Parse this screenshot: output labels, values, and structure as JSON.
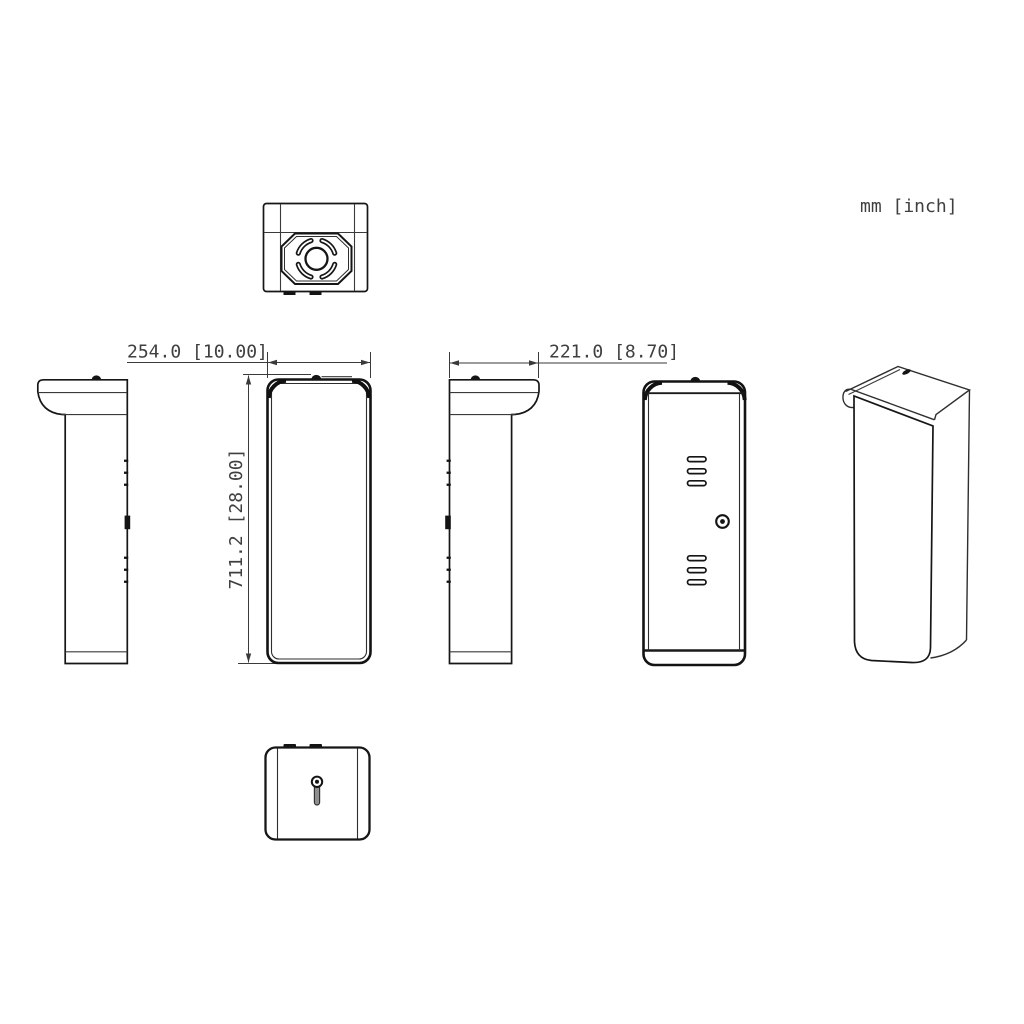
{
  "drawing": {
    "units_label": "mm [inch]",
    "dimensions": {
      "width": {
        "label": "254.0 [10.00]",
        "mm": "254.0",
        "inch": "10.00"
      },
      "depth": {
        "label": "221.0 [8.70]",
        "mm": "221.0",
        "inch": "8.70"
      },
      "height": {
        "label": "711.2 [28.00]",
        "mm": "711.2",
        "inch": "28.00"
      }
    },
    "colors": {
      "line": "#2e2e2e",
      "background": "#ffffff",
      "text": "#3f3f3f"
    }
  }
}
